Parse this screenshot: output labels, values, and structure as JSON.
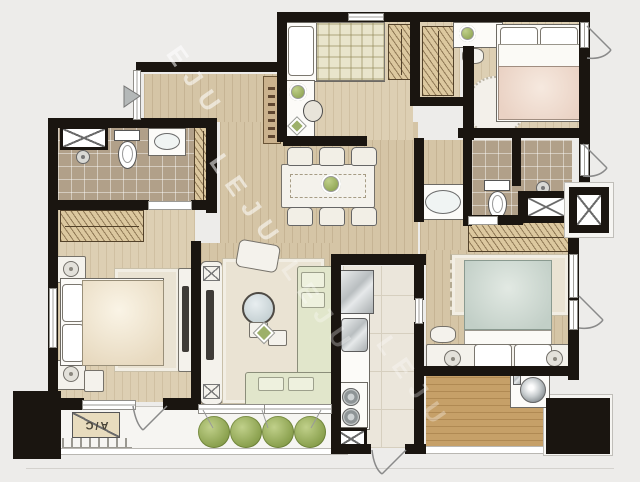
{
  "watermark": {
    "text": "LEJU",
    "partial_text": "EJU"
  },
  "labels": {
    "ac_unit": "A/C"
  },
  "colors": {
    "background": "#edecea",
    "wall": "#1a1510",
    "wood_floor": "#d5c5a6",
    "wood_floor_light": "#ddcfb3",
    "deck_wood": "#c6a068",
    "bathroom_tile": "#b1a089",
    "kitchen_tile": "#ebe6db",
    "sofa_green": "#e1e6cb",
    "plant_green": "#8da351",
    "duvet_cream": "#e7d9bf",
    "duvet_pink": "#ead2c4",
    "duvet_teal": "#c2cfc7",
    "wardrobe_tan": "#dcc89f",
    "furniture_white": "#fcfbf8"
  },
  "icons": [
    "double-bed",
    "single-bed",
    "pillow",
    "wardrobe-hangers",
    "toilet",
    "washbasin",
    "shower-head",
    "dining-table",
    "dining-chair",
    "l-sofa",
    "armchair",
    "round-coffee-table",
    "tv-console",
    "speaker",
    "refrigerator",
    "kitchen-sink",
    "gas-stove",
    "washing-machine",
    "plant-shrub",
    "potted-plant",
    "round-rug",
    "area-rug",
    "nightstand-lamp",
    "vanity-stool",
    "duct-shaft-x",
    "door-swing",
    "window",
    "sliding-door",
    "vent-triangle",
    "air-conditioner",
    "ladder-grill",
    "structural-column"
  ]
}
